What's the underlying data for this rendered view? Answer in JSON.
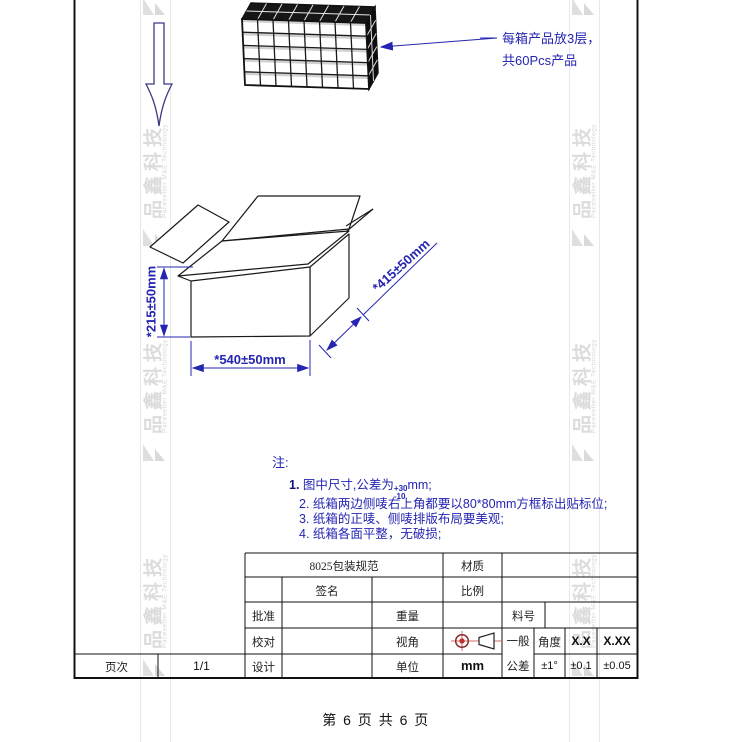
{
  "watermark": {
    "brand": "品鑫科技",
    "brand_sub": "Pacesetter M&E Technology"
  },
  "callout": {
    "line1": "每箱产品放3层，",
    "line2": "共60Pcs产品"
  },
  "dimensions": {
    "height": "*215±50mm",
    "width": "*540±50mm",
    "depth": "*415±50mm"
  },
  "notes": {
    "heading": "注:",
    "item1": {
      "prefix": "1.",
      "body": " 图中尺寸,公差为",
      "sup": "+30",
      "sub": "-10",
      "tail": "mm;"
    },
    "items": [
      "2. 纸箱两边侧唛右上角都要以80*80mm方框标出贴标位;",
      "3. 纸箱的正唛、侧唛排版布局要美观;",
      "4. 纸箱各面平整，无破损;"
    ]
  },
  "title_block": {
    "title": "8025包装规范",
    "material_label": "材质",
    "scale_label": "比例",
    "signature_label": "签名",
    "approve_label": "批准",
    "proofread_label": "校对",
    "design_label": "设计",
    "weight_label": "重量",
    "view_label": "视角",
    "unit_label": "单位",
    "unit_value": "mm",
    "part_no_label": "料号",
    "general_tol_line1": "一般",
    "general_tol_line2": "公差",
    "angle_label": "角度",
    "col_x_label": "X.X",
    "col_xx_label": "X.XX",
    "angle_tol": "±1°",
    "x_tol": "±0.1",
    "xx_tol": "±0.05",
    "page_label": "页次",
    "page_value": "1/1"
  },
  "footer": {
    "page_text": "第 6 页 共 6 页"
  },
  "colors": {
    "annotation_blue": "#2525b2",
    "drawing_black": "#151515",
    "symbol_red": "#cc4444"
  }
}
